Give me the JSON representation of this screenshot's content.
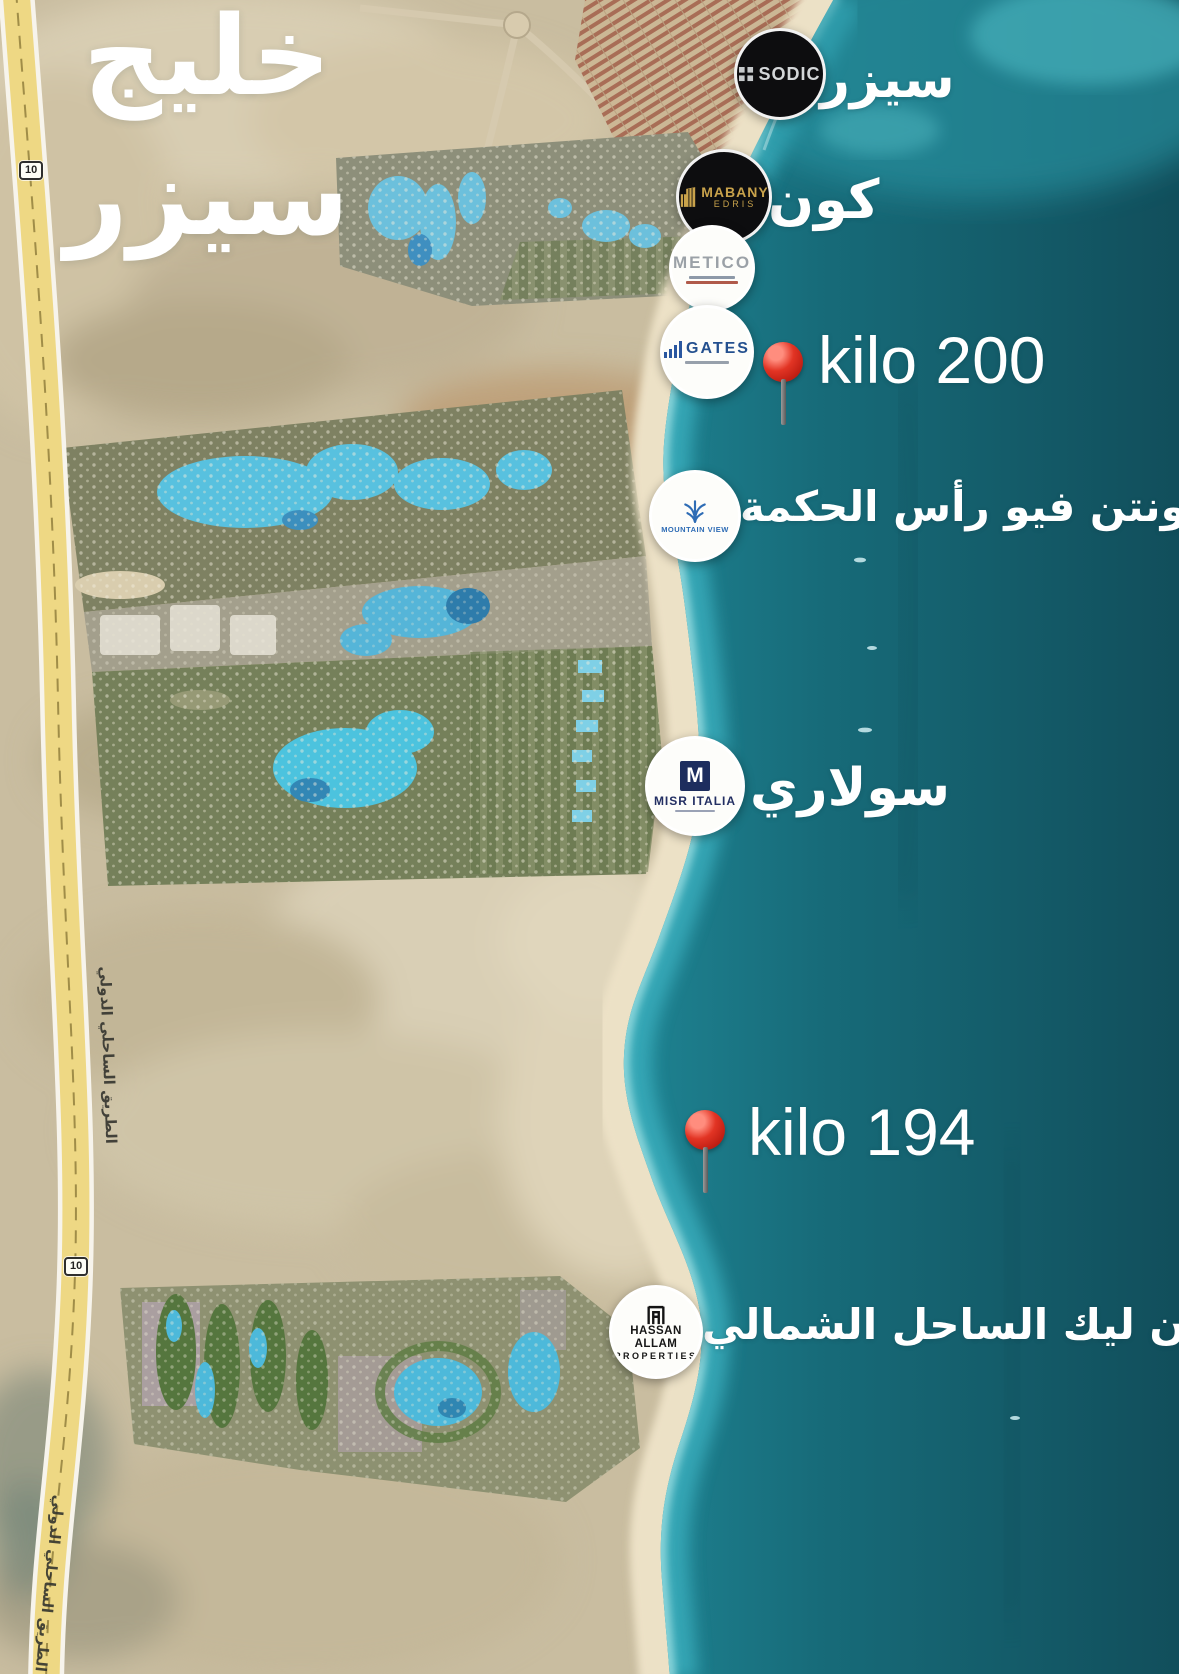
{
  "title": {
    "line1": "خليج",
    "line2": "سيزر"
  },
  "road": {
    "badge": "10",
    "name": "الطريق الساحلي الدولي"
  },
  "pins": [
    {
      "id": "kilo-200",
      "label": "kilo 200"
    },
    {
      "id": "kilo-194",
      "label": "kilo 194"
    }
  ],
  "markers": {
    "sodic": {
      "name": "SODIC",
      "label": "سيزر"
    },
    "mabany_edris": {
      "line1": "MABANY",
      "line2": "EDRIS",
      "label": "كون"
    },
    "metico": {
      "name": "METICO"
    },
    "gates": {
      "name": "GATES"
    },
    "mountain_view": {
      "name": "MOUNTAIN VIEW",
      "label": "ماونتن فيو رأس الحكمة"
    },
    "misr_italia": {
      "monogram": "M",
      "name": "MISR ITALIA",
      "label": "سولاري"
    },
    "hassan_allam": {
      "line1": "HASSAN ALLAM",
      "line2": "PROPERTIES",
      "label": "سوان ليك الساحل الشمالي"
    }
  },
  "icons": {
    "sodic": "grid-icon",
    "mabany_edris": "gold-building-icon",
    "gates": "bar-chart-icon",
    "mountain_view": "palm-icon",
    "hassan_allam": "gate-icon",
    "pin": "map-pin-icon"
  },
  "colors": {
    "sea_deep": "#114e5b",
    "sea_shore": "#3db3c2",
    "sand": "#c9bda0",
    "road_yellow": "#eed884",
    "pin_red": "#d9271c",
    "label_white": "#ffffff",
    "dark_marker_bg": "#0d0d0f",
    "gold": "#c8a24b",
    "navy": "#1d2d5e"
  }
}
